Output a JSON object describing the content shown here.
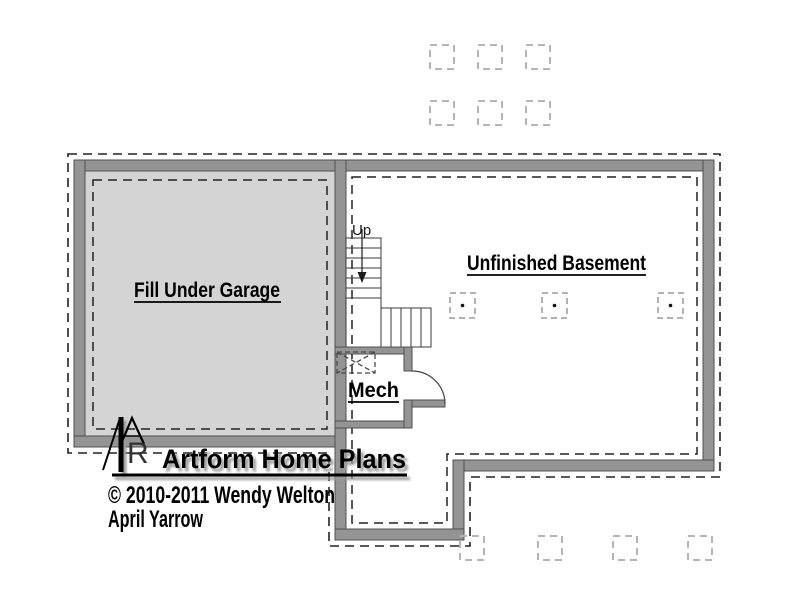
{
  "page": {
    "background": "#ffffff"
  },
  "plan": {
    "labels": {
      "garage": "Fill Under Garage",
      "basement": "Unfinished Basement",
      "mech": "Mech",
      "stairs_direction": "Up"
    },
    "colors": {
      "wall_fill": "#949494",
      "wall_edge": "#4f4f4f",
      "garage_fill": "#d4d4d4",
      "dash": "#222222",
      "pier_stroke": "#b5b5b5",
      "column_stroke": "#999999"
    },
    "piers_top": [
      [
        430,
        45
      ],
      [
        478,
        45
      ],
      [
        526,
        45
      ],
      [
        430,
        101
      ],
      [
        478,
        101
      ],
      [
        526,
        101
      ]
    ],
    "piers_bottom": [
      [
        460,
        536
      ],
      [
        538,
        536
      ],
      [
        613,
        536
      ],
      [
        688,
        536
      ]
    ],
    "columns": [
      [
        450,
        293
      ],
      [
        542,
        293
      ],
      [
        658,
        293
      ]
    ],
    "pier_size": 24,
    "column_size": 25
  },
  "title_block": {
    "logo_text": "Artform Home Plans",
    "monogram_letter": "R",
    "copyright_line1": "© 2010-2011 Wendy Welton",
    "copyright_line2": "April Yarrow"
  }
}
